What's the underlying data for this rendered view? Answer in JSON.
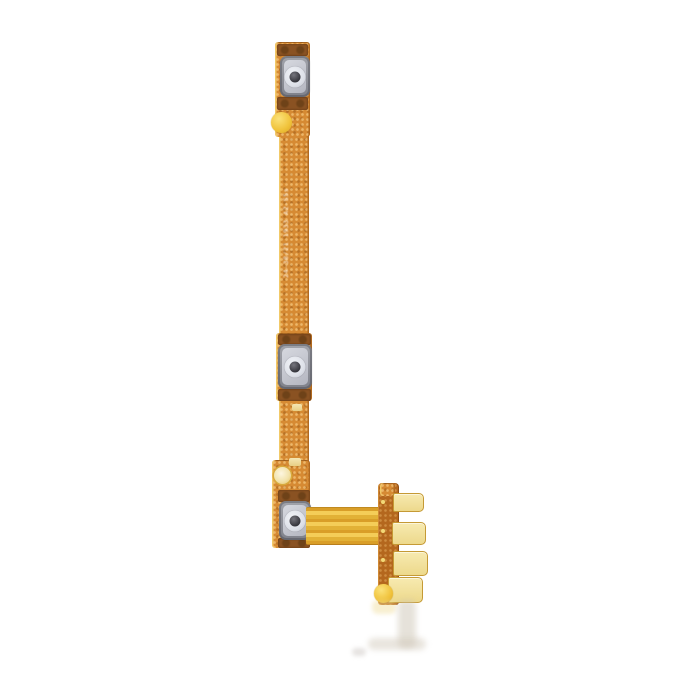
{
  "image": {
    "description": "Power and volume button flex cable spare part photographed on a plain white background",
    "background_color": "#ffffff"
  },
  "ribbon_label": {
    "text": "24-38/21 1933 A2-S5s"
  },
  "palette": {
    "bg": "#ffffff",
    "flex_orange": "#D68A33",
    "flex_orange_dark": "#B26A1F",
    "flex_highlight": "#F2C968",
    "solder_brown": "#6E4218",
    "button_frame_gray": "#8F9098",
    "button_inner_silver": "#D6D8DF",
    "button_ring_white": "#F2F4F8",
    "button_center_dark": "#35353C",
    "gold_pad": "#EDD98C",
    "gold_bright": "#F0C23A",
    "connector_brown": "#B4671E",
    "ribbon_gold": "#E9B93C"
  },
  "parts": {
    "strip": "vertical flex ribbon",
    "buttons": [
      "top metal dome switch",
      "middle metal dome switch",
      "bottom metal dome switch"
    ],
    "connector": "board-to-board contact fingers",
    "finger_count": 4
  }
}
